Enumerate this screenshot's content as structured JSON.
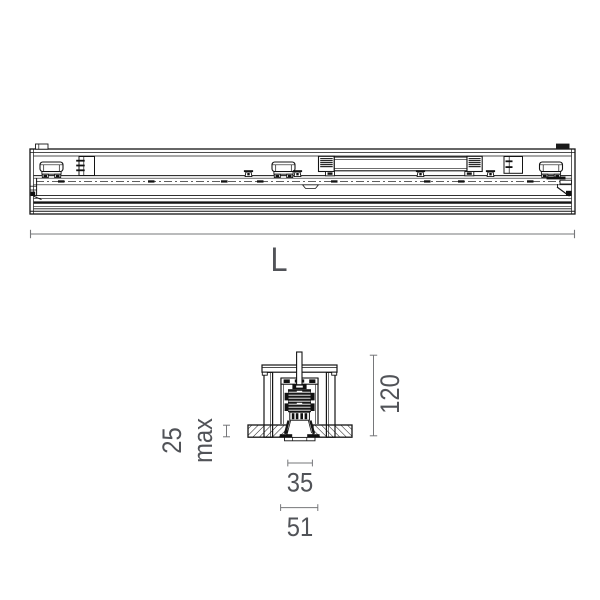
{
  "page": {
    "background": "#ffffff"
  },
  "drawing": {
    "line_color": "#141414",
    "dimension_line_color": "#76777a",
    "dimension_text_color": "#515358",
    "dimensions": {
      "length_label": "L",
      "total_height": "120",
      "ceiling_max_value": "25",
      "ceiling_max_unit": "max",
      "body_width": "35",
      "flange_width": "51"
    }
  }
}
